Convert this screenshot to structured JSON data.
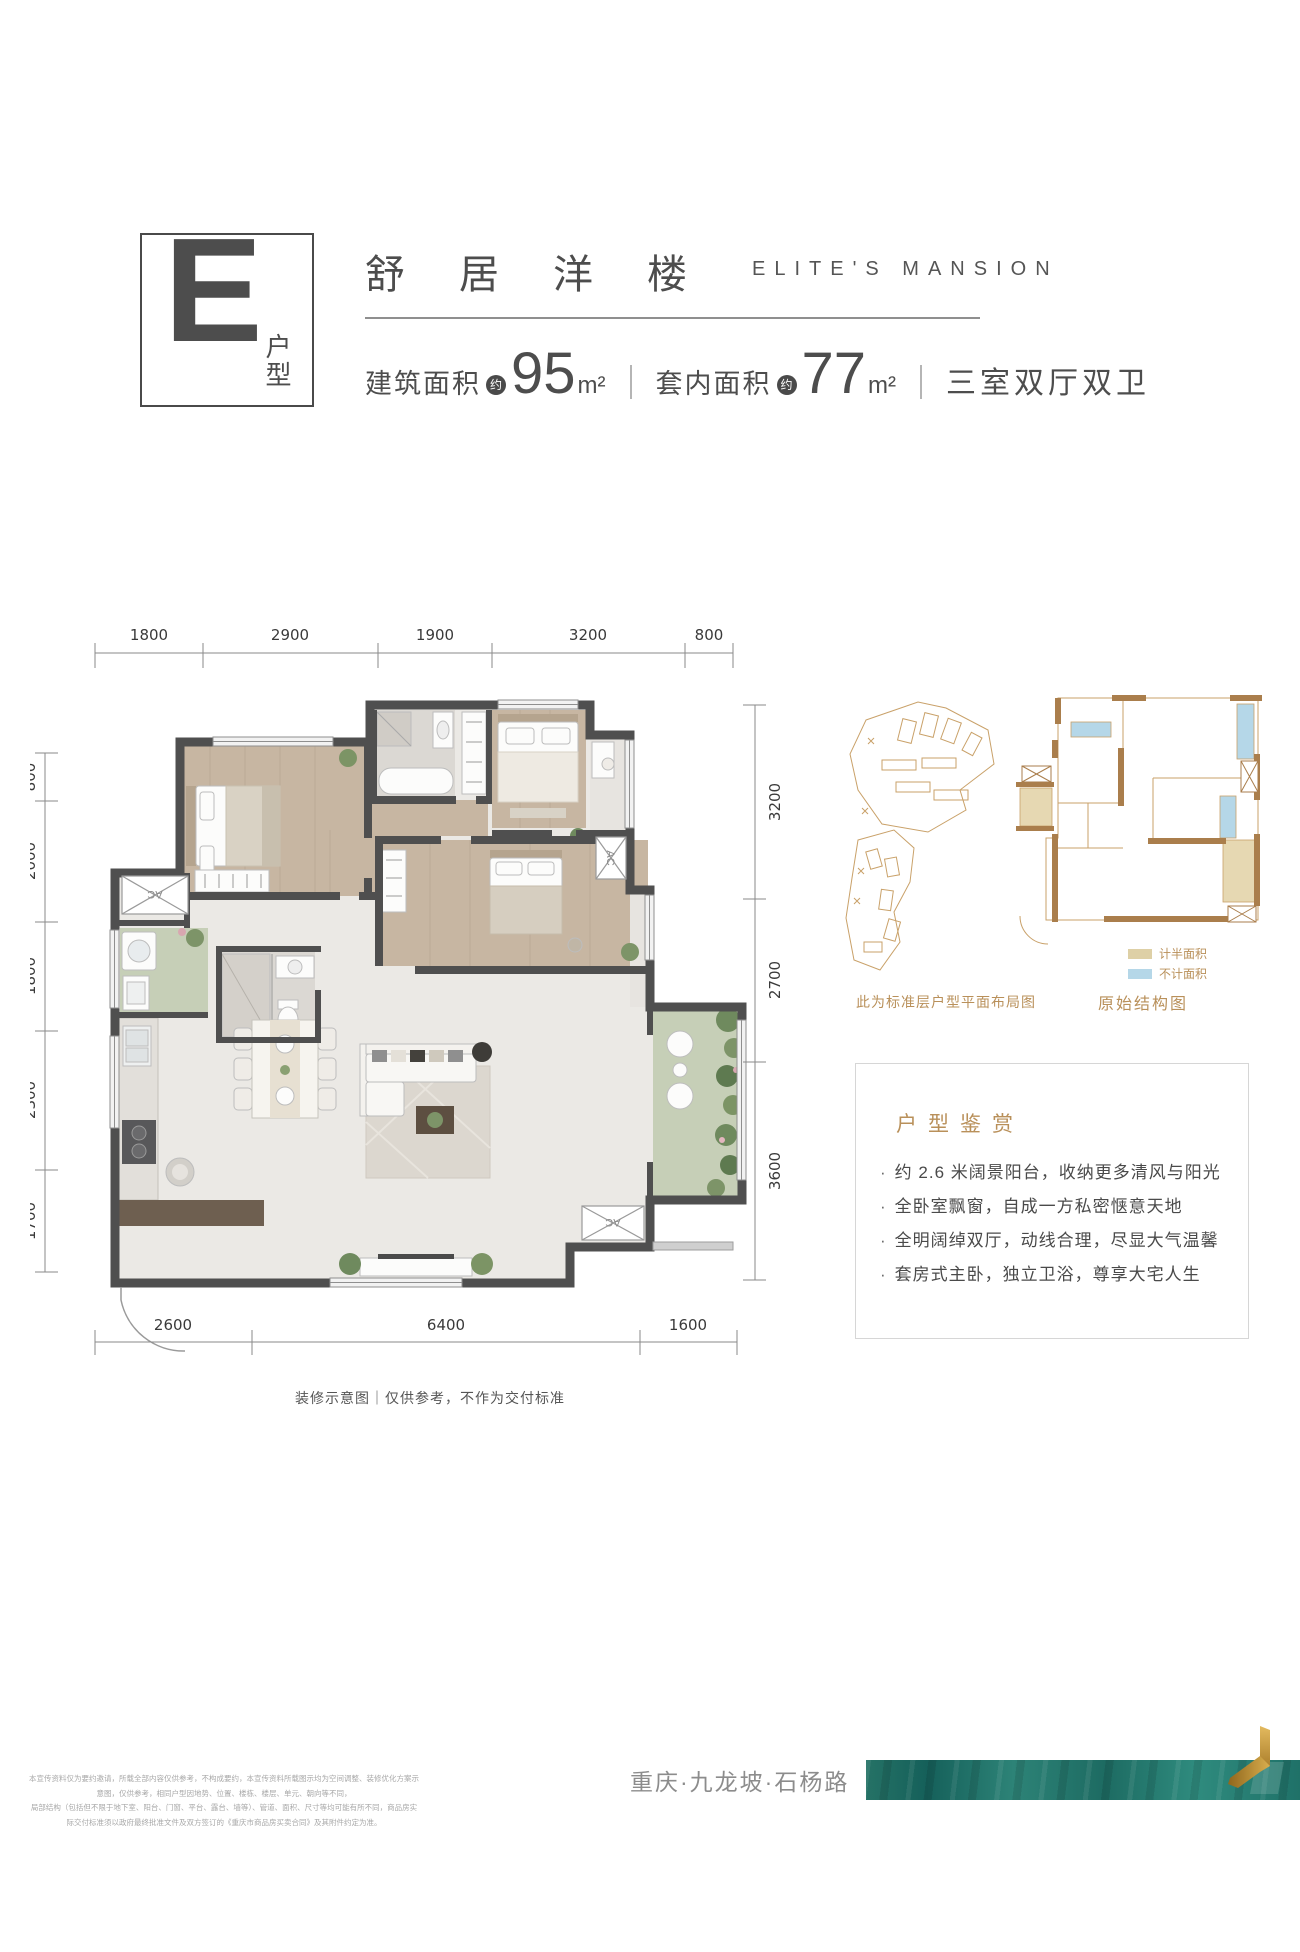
{
  "header": {
    "type_letter": "E",
    "type_label": "户型",
    "title_cn": "舒居洋楼",
    "title_en": "ELITE'S MANSION",
    "area_built_label": "建筑面积",
    "approx": "约",
    "area_built_value": "95",
    "area_unit": "m²",
    "area_inner_label": "套内面积",
    "area_inner_value": "77",
    "layout_text": "三室双厅双卫"
  },
  "floorplan": {
    "dims_top": [
      "1800",
      "2900",
      "1900",
      "3200",
      "800"
    ],
    "dims_left": [
      "800",
      "2000",
      "1800",
      "2300",
      "1700"
    ],
    "dims_right": [
      "3200",
      "2700",
      "3600"
    ],
    "dims_bottom": [
      "2600",
      "6400",
      "1600"
    ],
    "ac_label": "AC",
    "caption": "装修示意图｜仅供参考，不作为交付标准"
  },
  "annex": {
    "siteplan_caption": "此为标准层户型平面布局图",
    "structure_caption": "原始结构图",
    "legend": [
      {
        "label": "计半面积",
        "color": "#ded0a6"
      },
      {
        "label": "不计面积",
        "color": "#b5d7e8"
      }
    ]
  },
  "highlights": {
    "title": "户型鉴赏",
    "bullet": "·",
    "items": [
      "约 2.6 米阔景阳台，收纳更多清风与阳光",
      "全卧室飘窗，自成一方私密惬意天地",
      "全明阔绰双厅，动线合理，尽显大气温馨",
      "套房式主卧，独立卫浴，尊享大宅人生"
    ]
  },
  "footer": {
    "disclaimer_line1": "本宣传资料仅为要约邀请，所载全部内容仅供参考，不构成要约，本宣传资料所载图示均为空间调整、装修优化方案示意图，仅供参考，相同户型因地势、位置、楼栋、楼层、单元、朝向等不同，",
    "disclaimer_line2": "局部结构（包括但不限于地下室、阳台、门窗、平台、露台、墙等）、管道、面积、尺寸等均可能有所不同，商品房实际交付标准须以政府最终批准文件及双方签订的《重庆市商品房买卖合同》及其附件约定为准。",
    "location": "重庆·九龙坡·石杨路"
  },
  "colors": {
    "accent_tan": "#b9905a",
    "wall_dark": "#4f4f4f",
    "structure_brown": "#aa7e4c",
    "legend_tan": "#ded0a6",
    "legend_blue": "#b5d7e8",
    "banner_teal": "#2a8176",
    "logo_gold": "#c79a3f"
  }
}
